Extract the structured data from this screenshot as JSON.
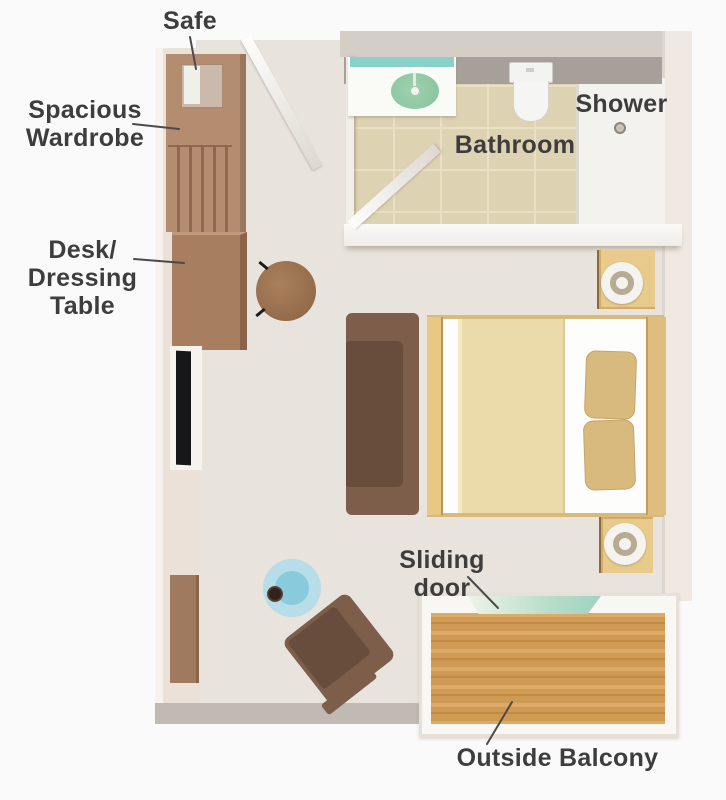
{
  "labels": {
    "safe": "Safe",
    "wardrobe": "Spacious\nWardrobe",
    "desk": "Desk/\nDressing\nTable",
    "bathroom": "Bathroom",
    "shower": "Shower",
    "sliding_door": "Sliding door",
    "balcony": "Outside Balcony"
  },
  "palette": {
    "wall_inner_gray": "#a7a09a",
    "wall_light_pink": "#ece1d9",
    "room_floor": "#e8e3dc",
    "bathroom_tile": "#ddd2b2",
    "wardrobe_brown": "#b48d70",
    "desk_brown": "#a77e60",
    "sofa_brown": "#7c5e4a",
    "seat_dark_brown": "#694d3c",
    "bed_frame_gold": "#d9ba7d",
    "blanket_cream": "#ecdbaa",
    "pillow_tan": "#d9ba7e",
    "vanity_teal": "#8ad2c9",
    "sink_green": "#8cc7a3",
    "balcony_wood": "#cf9a53",
    "side_table_blue": "#b7dde8",
    "tv_black": "#17171a",
    "label_text": "#3e3d3d"
  }
}
